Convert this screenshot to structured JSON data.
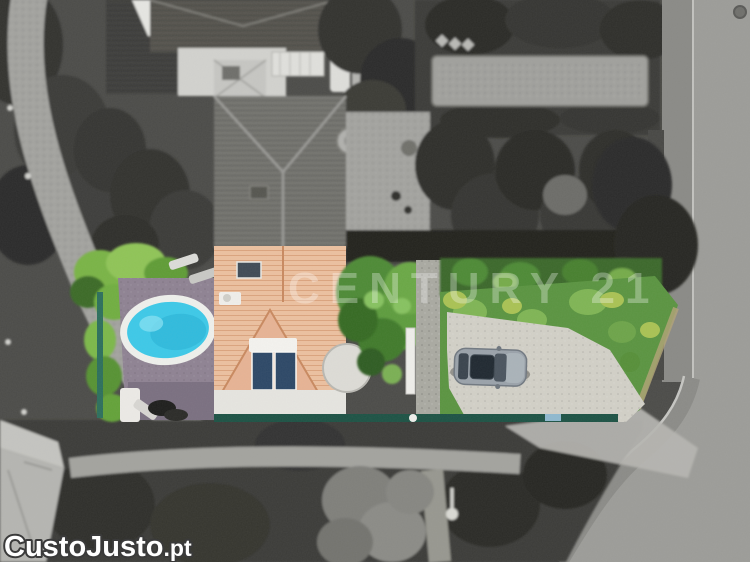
{
  "image": {
    "kind": "aerial-drone-photo",
    "width_px": 750,
    "height_px": 562
  },
  "watermarks": {
    "agency": "CENTURY 21",
    "site_main": "CustoJusto",
    "site_suffix": ".pt"
  },
  "scene": {
    "highlighted_lot_objects": [
      "house-salmon-tile-roof",
      "solar-panels",
      "roof-skylight",
      "oval-swimming-pool",
      "mauve-pool-deck",
      "climbing-plant-fence",
      "green-lawn",
      "garden-trees",
      "gravel-driveway",
      "parked-silver-car",
      "white-garden-gate",
      "teal-boundary-fence"
    ],
    "grayscale_surroundings": [
      "neighbor-house-roofs",
      "park-path",
      "street-with-sidewalk",
      "manhole-cover",
      "long-rectangular-court",
      "dense-trees",
      "bottom-left-building-roof",
      "street-lamp"
    ]
  },
  "colors": {
    "pool_water": "#3cc9e8",
    "roof_tiles": "#ecc0a0",
    "lawn_green": "#5a9440",
    "deck_mauve": "#8e8292",
    "boundary_fence_teal": "#1c5244",
    "road_gray": "#9c9c98",
    "watermark_white": "#ffffff"
  }
}
